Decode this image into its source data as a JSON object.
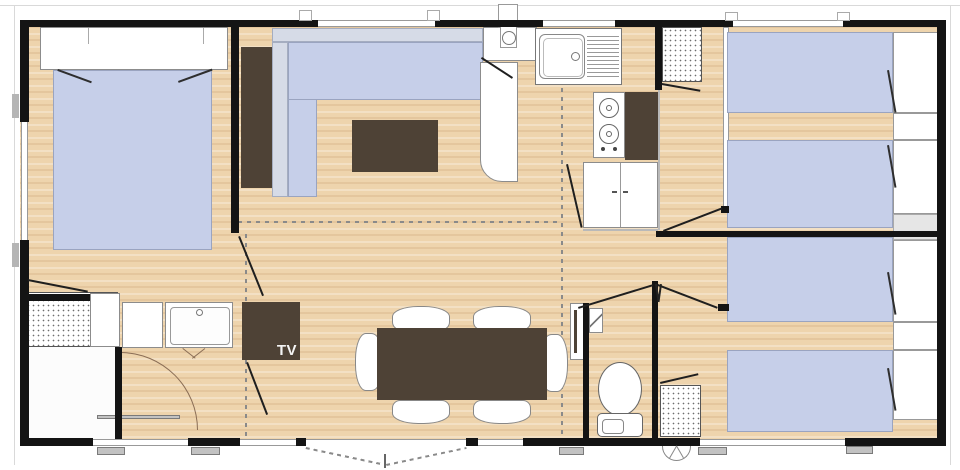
{
  "labels": {
    "tv_unit": "TV"
  },
  "palette": {
    "wall": "#141414",
    "floor_wood": "#eed4ad",
    "bed_fabric": "#c6cfe9",
    "sofa_back": "#d6dbe7",
    "furniture_dark_brown": "#4e4236",
    "fixture_white": "#ffffff",
    "window_line": "#999999",
    "step_mat_grey": "#c2c2c2",
    "dashed_zone_line": "#8a8a8a"
  },
  "plan_content": {
    "type": "mobile-home floor plan, top view",
    "fixture_icons": [
      "double-bed-icon",
      "single-bed-icon",
      "pillow-icon",
      "wardrobe-icon",
      "l-sofa-icon",
      "coffee-table-icon",
      "tv-unit-icon",
      "dining-table-icon",
      "chair-icon",
      "kitchen-sink-icon",
      "drainer-icon",
      "hob-icon",
      "fridge-icon",
      "base-cabinet-icon",
      "pantry-shelf-icon",
      "shower-icon",
      "washbasin-icon",
      "vanity-icon",
      "toilet-icon",
      "corner-basin-icon",
      "door-leaf-icon",
      "door-swing-icon",
      "window-icon",
      "entrance-double-door-icon",
      "step-mat-icon",
      "vent-fan-icon",
      "flue-pipe-icon"
    ],
    "zones_visible": [
      "master-bedroom-left",
      "living-lounge-top-middle",
      "kitchen-top-right-of-centre",
      "bathroom-with-shower-bottom-left",
      "dining-area-bottom-middle",
      "wc-room",
      "twin-bedroom-top-right",
      "twin-bedroom-bottom-right",
      "hallway"
    ]
  }
}
